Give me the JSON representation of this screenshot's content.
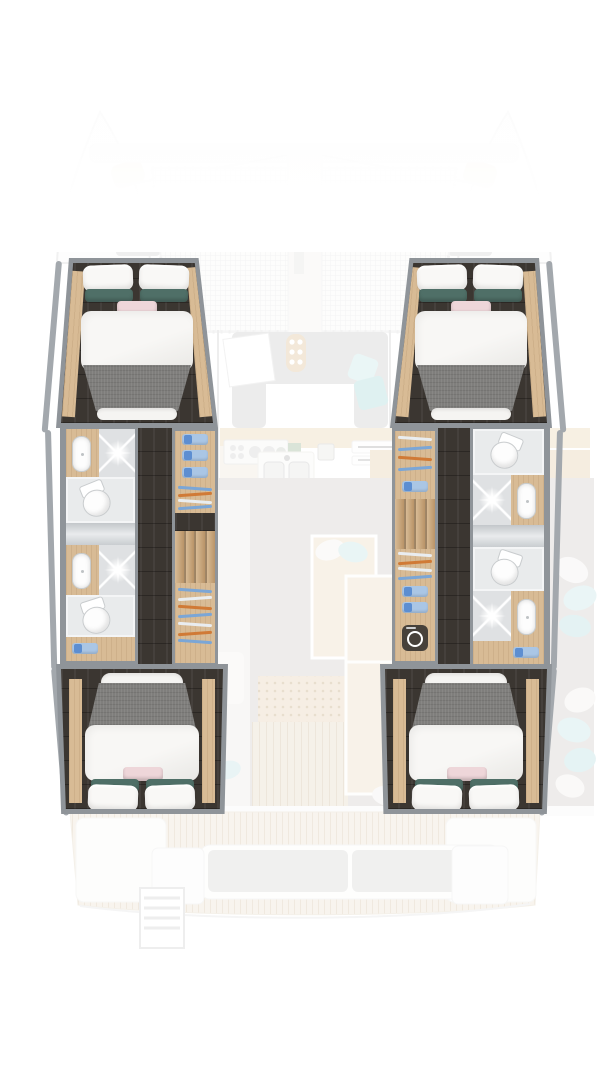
{
  "page": {
    "type": "floor-plan rendering",
    "subject": "catamaran yacht 4-cabin interior layout, top-down view",
    "visible_text": [],
    "highlighted_areas": [
      "port hull",
      "starboard hull"
    ],
    "faded_areas": [
      "bow trampoline",
      "saloon",
      "galley",
      "cockpit",
      "aft deck"
    ]
  },
  "colors": {
    "frame": "#8f9499",
    "hull_wall": "#a3a8ad",
    "dark_floor": "#3b3631",
    "wood": "#d8bb95",
    "wood_dark": "#b99468",
    "tile": "#dfe1e3",
    "tile_light": "#e9ebec",
    "white_fixture": "#fdfdfd",
    "blanket": "#7f7e7c",
    "pillow_white": "#f9f8f6",
    "pillow_teal": "#4f6f67",
    "pillow_pink": "#eed6d9",
    "towel": "#aac6e5",
    "towel_dark": "#5d8ed1",
    "hanger_blue": "#7ba6d6",
    "hanger_orange": "#d07a36",
    "washer_dark": "#47413a",
    "sofa_gray": "#d4d4d2",
    "cushion_teal": "#bfe2e4",
    "counter_wood": "#eedcbd",
    "cockpit_floor": "#d8d4d0",
    "deck_wood": "#efe7d9"
  },
  "rooms": {
    "port_hull": {
      "forward_cabin": {
        "name": "port forward cabin",
        "furniture": [
          "island double bed",
          "wood side shelves"
        ]
      },
      "forward_bathroom": {
        "name": "port forward bathroom",
        "fixtures": [
          "sink",
          "shower",
          "toilet"
        ]
      },
      "aft_bathroom": {
        "name": "port aft bathroom",
        "fixtures": [
          "sink",
          "shower",
          "toilet"
        ]
      },
      "storage": [
        "towel shelves",
        "hanging rod",
        "wardrobe with hangers",
        "towel cubby"
      ],
      "companionway": {
        "name": "port companionway steps",
        "treads": 4
      },
      "aft_cabin": {
        "name": "port aft cabin",
        "furniture": [
          "island double bed"
        ]
      }
    },
    "starboard_hull": {
      "forward_cabin": {
        "name": "starboard forward cabin",
        "furniture": [
          "island double bed",
          "wood side shelves"
        ]
      },
      "forward_bathroom": {
        "name": "starboard forward bathroom",
        "fixtures": [
          "toilet",
          "shower",
          "sink"
        ]
      },
      "aft_bathroom": {
        "name": "starboard aft bathroom",
        "fixtures": [
          "toilet",
          "shower",
          "sink"
        ]
      },
      "storage": [
        "wardrobe with hangers",
        "towel cubbies",
        "hanging rod"
      ],
      "appliance": "washing machine",
      "companionway": {
        "name": "starboard companionway steps",
        "treads": 4
      },
      "aft_cabin": {
        "name": "starboard aft cabin",
        "furniture": [
          "island double bed"
        ]
      }
    },
    "center": {
      "bow": {
        "name": "bow",
        "features": [
          "crossbeam",
          "trampoline net",
          "central walkway",
          "anchor hatches"
        ]
      },
      "saloon": {
        "name": "saloon",
        "features": [
          "U-sofa",
          "table",
          "teal cushions",
          "door panel"
        ]
      },
      "galley": {
        "name": "galley",
        "features": [
          "stove with burners",
          "double sink",
          "vent grilles",
          "counters"
        ]
      },
      "cockpit": {
        "name": "cockpit",
        "features": [
          "chaise lounge",
          "large table",
          "seat cushions",
          "teak floor"
        ]
      },
      "aft_deck": {
        "name": "aft deck",
        "features": [
          "stern bench with gray cushions",
          "swim ladder"
        ]
      }
    }
  },
  "icons": [
    "sparkle-highlight-icon",
    "washing-machine-icon",
    "hanger-icon",
    "towel-icon",
    "toilet-icon",
    "sink-icon",
    "shower-icon",
    "swim-ladder-icon",
    "stove-burner-icon"
  ],
  "bed_styling": {
    "pillows": "2 white",
    "lumbar_pillows": "2 teal + 1 pink",
    "duvet": "white",
    "throw_blanket": "gray"
  }
}
